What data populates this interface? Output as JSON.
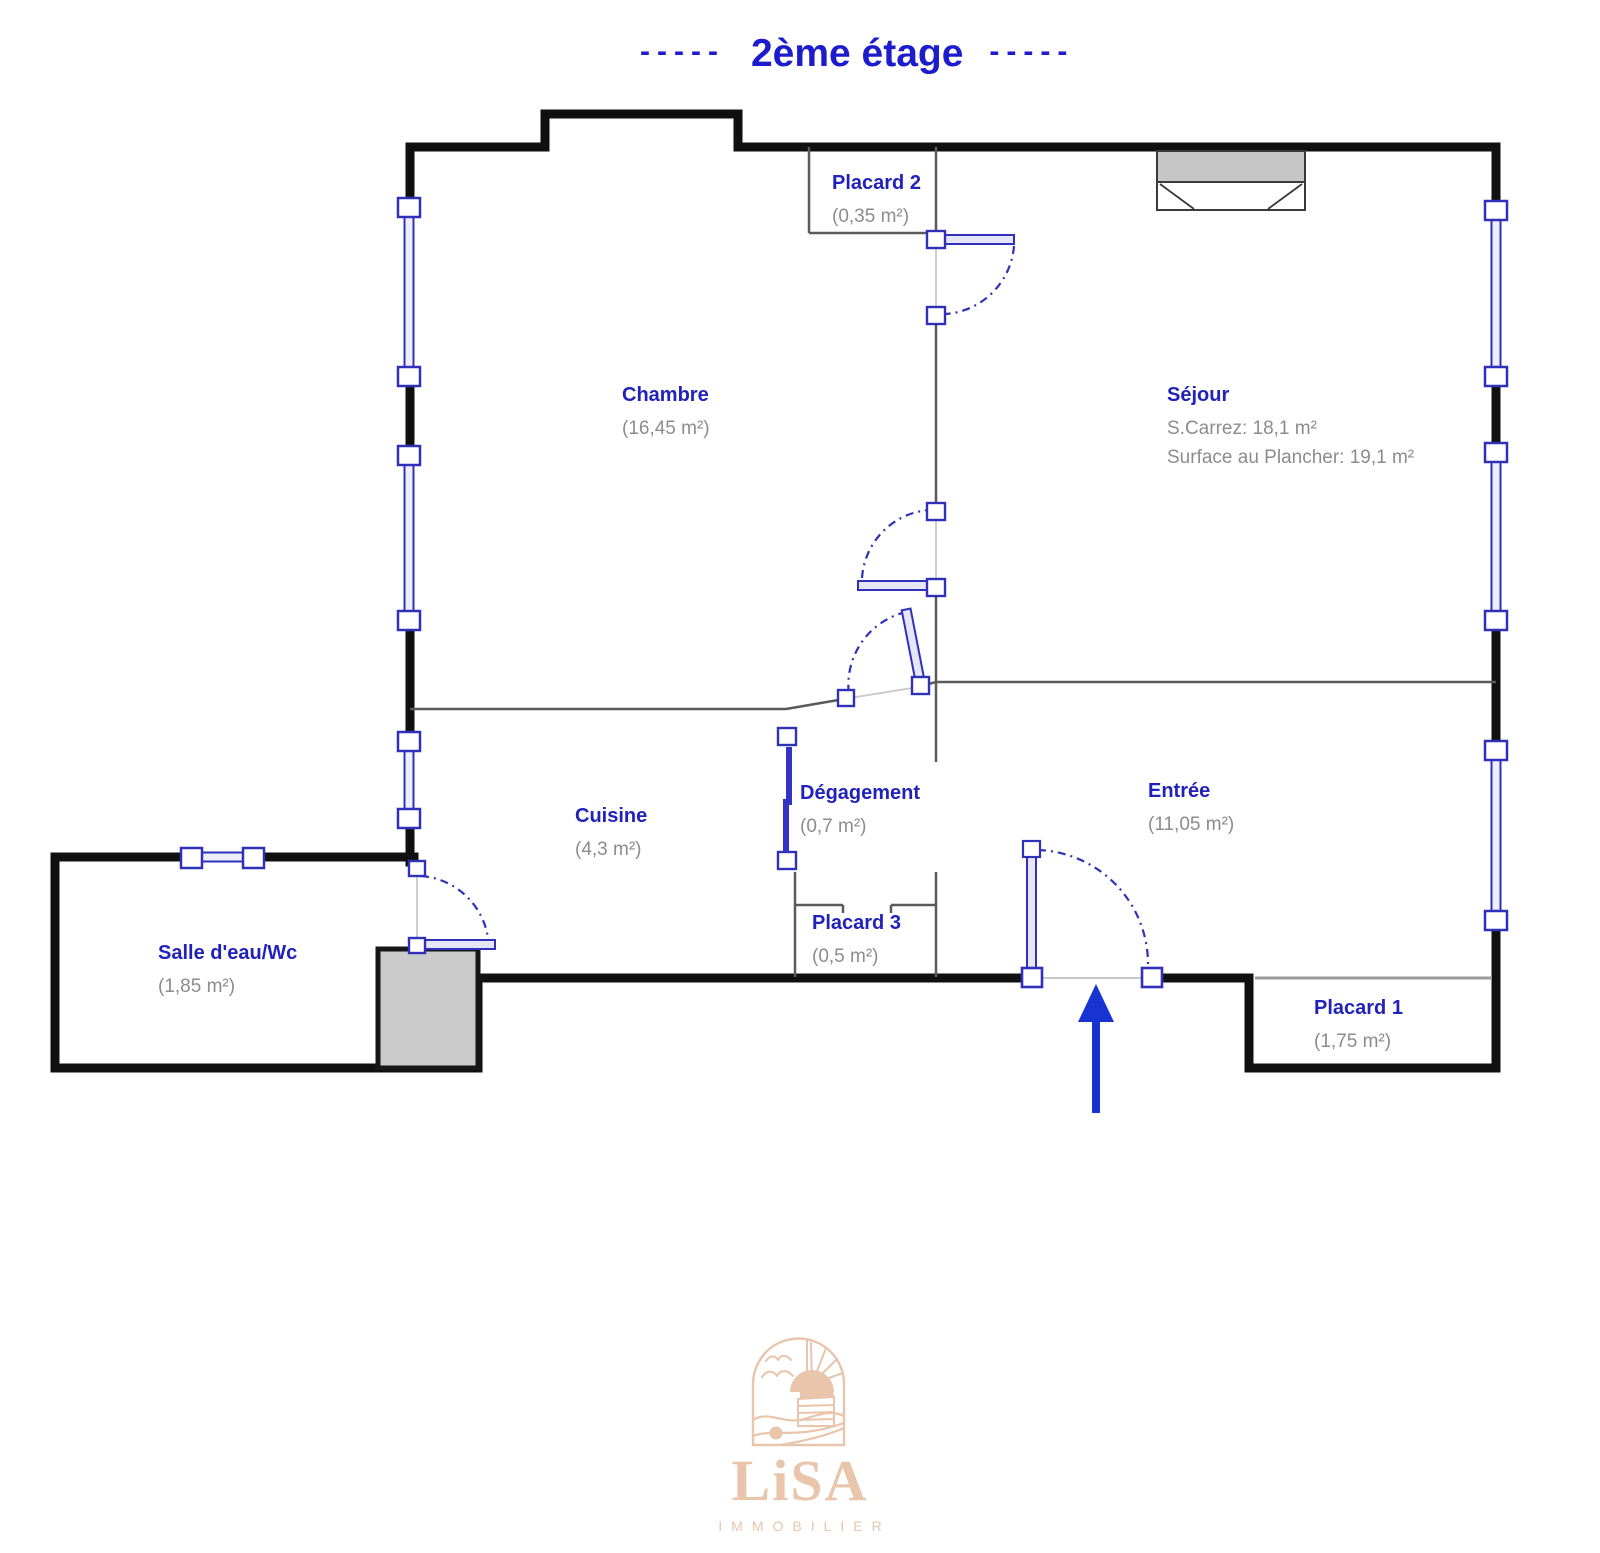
{
  "title": {
    "dashes_left": "-----",
    "text": "2ème étage",
    "dashes_right": "-----"
  },
  "rooms": {
    "chambre": {
      "name": "Chambre",
      "detail1": "(16,45 m²)"
    },
    "sejour": {
      "name": "Séjour",
      "detail1": "S.Carrez: 18,1 m²",
      "detail2": "Surface au Plancher: 19,1 m²"
    },
    "placard2": {
      "name": "Placard 2",
      "detail1": "(0,35 m²)"
    },
    "cuisine": {
      "name": "Cuisine",
      "detail1": "(4,3 m²)"
    },
    "degagement": {
      "name": "Dégagement",
      "detail1": "(0,7 m²)"
    },
    "entree": {
      "name": "Entrée",
      "detail1": "(11,05 m²)"
    },
    "placard3": {
      "name": "Placard 3",
      "detail1": "(0,5 m²)"
    },
    "salle_eau": {
      "name": "Salle d'eau/Wc",
      "detail1": "(1,85 m²)"
    },
    "placard1": {
      "name": "Placard 1",
      "detail1": "(1,75 m²)"
    }
  },
  "logo": {
    "brand": "LiSA",
    "tagline": "IMMOBILIER"
  },
  "colors": {
    "title_blue": "#1c1ccd",
    "label_blue": "#2122bb",
    "detail_gray": "#8c8c8c",
    "wall_black": "#101010",
    "fixture_blue": "#3030b8",
    "arrow_blue": "#1733d2",
    "logo_beige": "#e8c5ab"
  }
}
